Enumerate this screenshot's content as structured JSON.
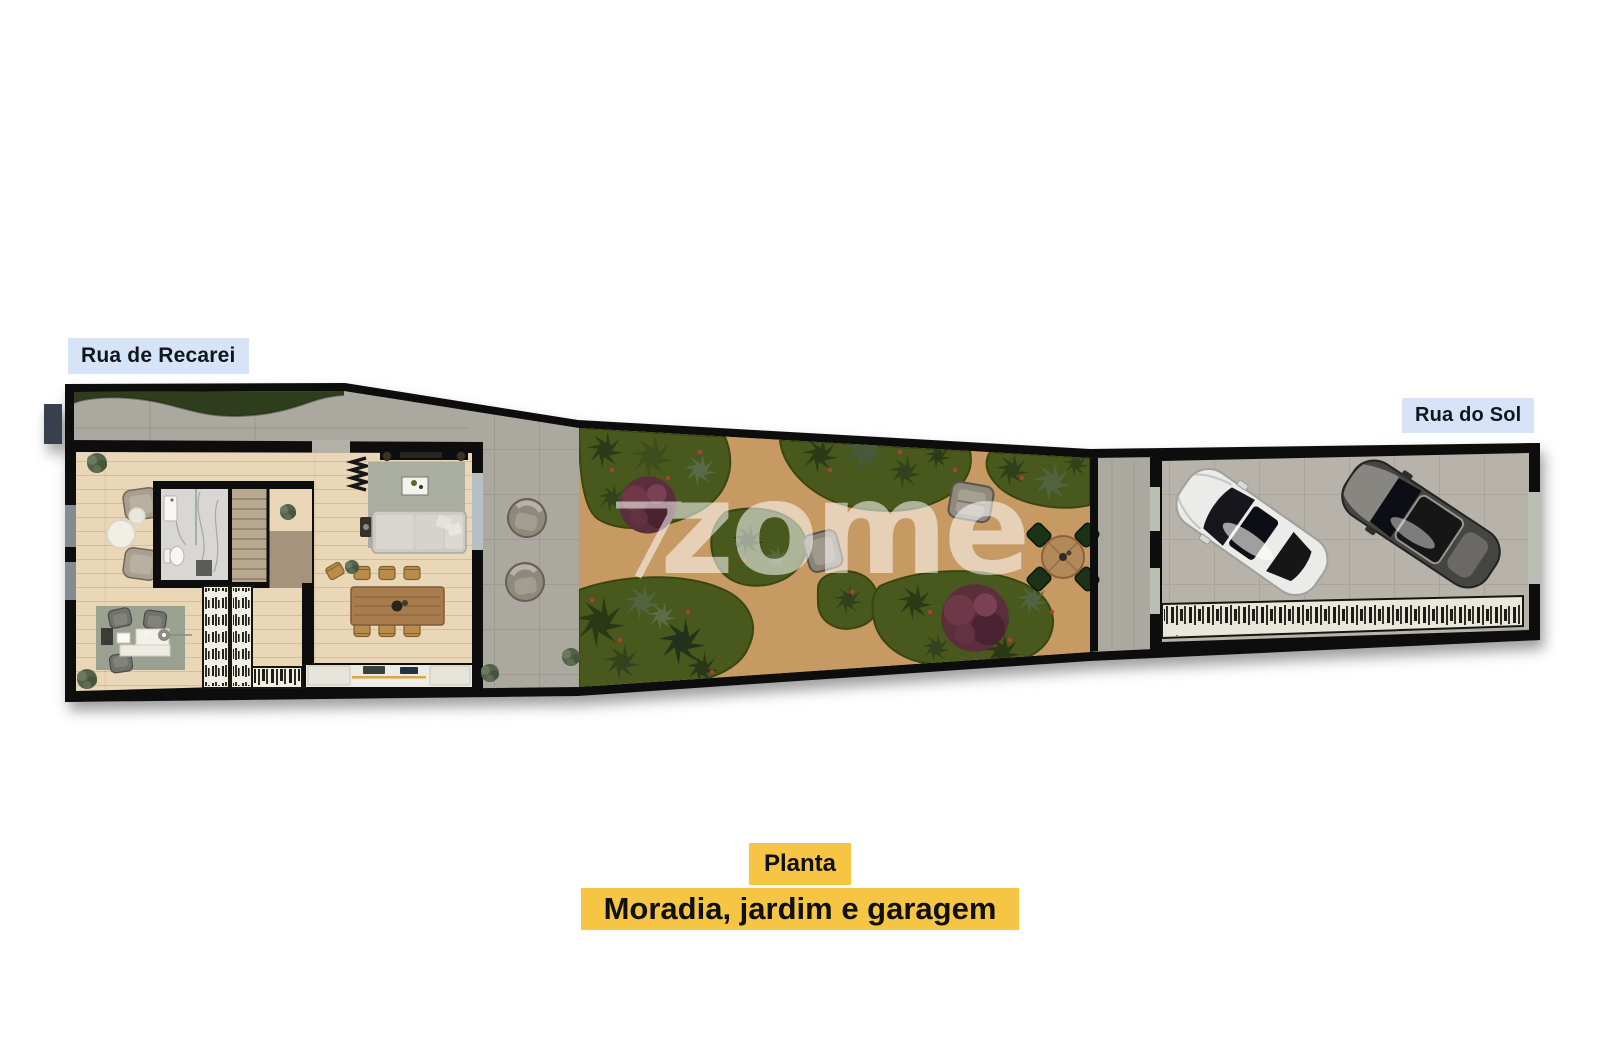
{
  "canvas": {
    "width": 1600,
    "height": 1062,
    "background": "#ffffff"
  },
  "street_labels": {
    "top_left": "Rua de Recarei",
    "right": "Rua do Sol"
  },
  "caption": {
    "title": "Planta",
    "subtitle": "Moradia, jardim e garagem"
  },
  "watermark": {
    "text": "zome"
  },
  "colors": {
    "street_label_bg": "#d7e3f7",
    "street_label_text": "#10161f",
    "caption_bg": "#f6c544",
    "caption_text": "#101010",
    "wall": "#101010",
    "concrete": "#aba89f",
    "wood_floor": "#e9d7b8",
    "grass_verge": "#2e3d1c",
    "garden_green": "#49591f",
    "path_sand": "#c89a63",
    "garage_floor": "#b7b3aa",
    "living_rug": "#a9ada2",
    "office_rug": "#9aa191",
    "table_wood": "#a87c4e",
    "stairs": "#b7a88f",
    "bathroom_marble": "#d8d7d4",
    "car_white": "#ebebe9",
    "car_dark": "#454543"
  }
}
